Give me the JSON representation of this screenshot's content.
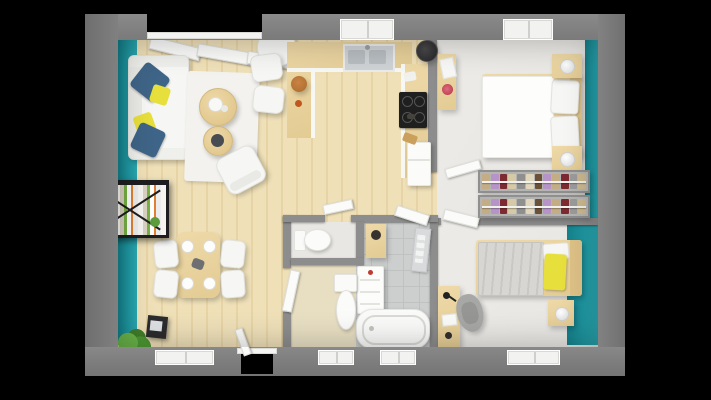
{
  "meta": {
    "title": "3D rendered top-down floor plan of a two-bedroom apartment",
    "render_style": "photorealistic 3D dollhouse view on black background"
  },
  "colors": {
    "background": "#000000",
    "wall": "#7a7a7a",
    "wall_inner": "#8d8d8d",
    "teal": "#1f98a2",
    "wood_light": "#efe0b8",
    "wood_dark": "#e7d4a6",
    "counter_wood": "#eed9a8",
    "furniture_wood": "#e9d19f",
    "bedroom_floor": "#e8e6e2",
    "tile": "#cdcfcf",
    "beige": "#e8dfc3",
    "white_furniture": "#f6f6f4",
    "pillow_blue": "#3e6487",
    "pillow_yellow": "#e7df3b",
    "duvet_grey": "#d8d6d3",
    "chair_grey": "#a7a7a5",
    "plant_green": "#55a238",
    "frame_black": "#1e1e20"
  },
  "rooms": [
    {
      "name": "living-room",
      "floor": "light wood planks",
      "accent_wall": "teal on left",
      "furniture": [
        "white sofa with blue and yellow cushions",
        "white area rug",
        "round wooden coffee table",
        "small round side table",
        "white armchair",
        "round white cafe table with two white chairs",
        "black wall-mounted bookshelf with books and plants",
        "green potted plant",
        "black stove cabinet",
        "tilted white window panels"
      ]
    },
    {
      "name": "dining-area",
      "floor": "light wood planks",
      "furniture": [
        "wooden dining table set for four with white plates",
        "four white chairs"
      ]
    },
    {
      "name": "kitchen",
      "floor": "light wood planks",
      "furniture": [
        "U-shaped wooden counter",
        "stainless double sink",
        "black four-burner cooktop",
        "cylindrical range hood",
        "white refrigerator",
        "wooden fruit bowl",
        "counter items"
      ]
    },
    {
      "name": "bedroom-1",
      "floor": "pale grey",
      "accent_wall": "teal on right",
      "furniture": [
        "double bed with white duvet and two pillows",
        "two wooden nightstands with ball lamps",
        "wooden shelf with red flowers and towel"
      ]
    },
    {
      "name": "dressing-area",
      "floor": "pale grey",
      "furniture": [
        "two parallel clothes rails with hanging garments"
      ]
    },
    {
      "name": "bedroom-2",
      "floor": "pale grey",
      "accent_wall": "teal on right",
      "furniture": [
        "single bed with grey duvet and yellow pillow",
        "wooden nightstand with lamp",
        "wooden desk with black lamp",
        "grey swivel chair"
      ]
    },
    {
      "name": "bathroom",
      "floor": "grey tile with beige section",
      "furniture": [
        "bathtub",
        "toilet",
        "white drawer cabinet",
        "wooden vanity shelf",
        "towel rail"
      ]
    },
    {
      "name": "wc",
      "floor": "pale grey",
      "furniture": [
        "toilet"
      ]
    }
  ],
  "wardrobe": {
    "clothes_colors": [
      "#c4ad84",
      "#b794c8",
      "#7d2b31",
      "#d6c9a5",
      "#8f8f8f",
      "#e0d6bb",
      "#6b4f37",
      "#b794c8",
      "#c4ad84",
      "#7d2b31",
      "#9b9b9b",
      "#cbb88e"
    ]
  },
  "openings": {
    "top_windows": [
      "living-room bay window",
      "kitchen window",
      "bedroom-1 window"
    ],
    "bottom_windows": [
      "dining window",
      "hall window",
      "bathroom window",
      "bedroom-2 window"
    ],
    "front_door": "bottom wall between dining area and hall",
    "interior_doors": [
      "bedroom-1 door (open)",
      "bedroom-2 door (open)",
      "bathroom door (open)",
      "wc door (open)"
    ]
  }
}
